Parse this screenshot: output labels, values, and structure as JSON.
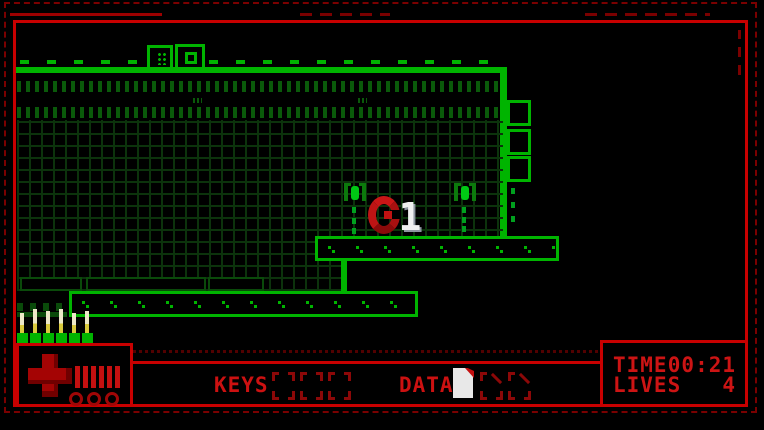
{
  "hud": {
    "keys": {
      "label": "KEYS",
      "slots": 3,
      "collected": 0
    },
    "data": {
      "label": "DATA",
      "slots": 3,
      "collected": 1
    },
    "time": {
      "label": "TIME",
      "value": "00:21"
    },
    "lives": {
      "label": "LIVES",
      "value": "4"
    },
    "health": {
      "segments": 6,
      "reserve_markers": 3
    }
  },
  "player": {
    "glyph": "1"
  },
  "colors": {
    "border_bright": "#c80000",
    "border_dim": "#7a0000",
    "platform_green": "#00b400",
    "texture_green": "#0a5a0a",
    "grid_green": "#0c330c",
    "structure_green": "#0a4a0a",
    "hud_text_red": "#cc1111",
    "slot_red": "#8c0808",
    "enemy_red": "#c81616",
    "player_white": "#f0f0f0",
    "candle_cream": "#ece8c8",
    "candle_yellow": "#d8c83c",
    "health_red": "#a40404"
  }
}
